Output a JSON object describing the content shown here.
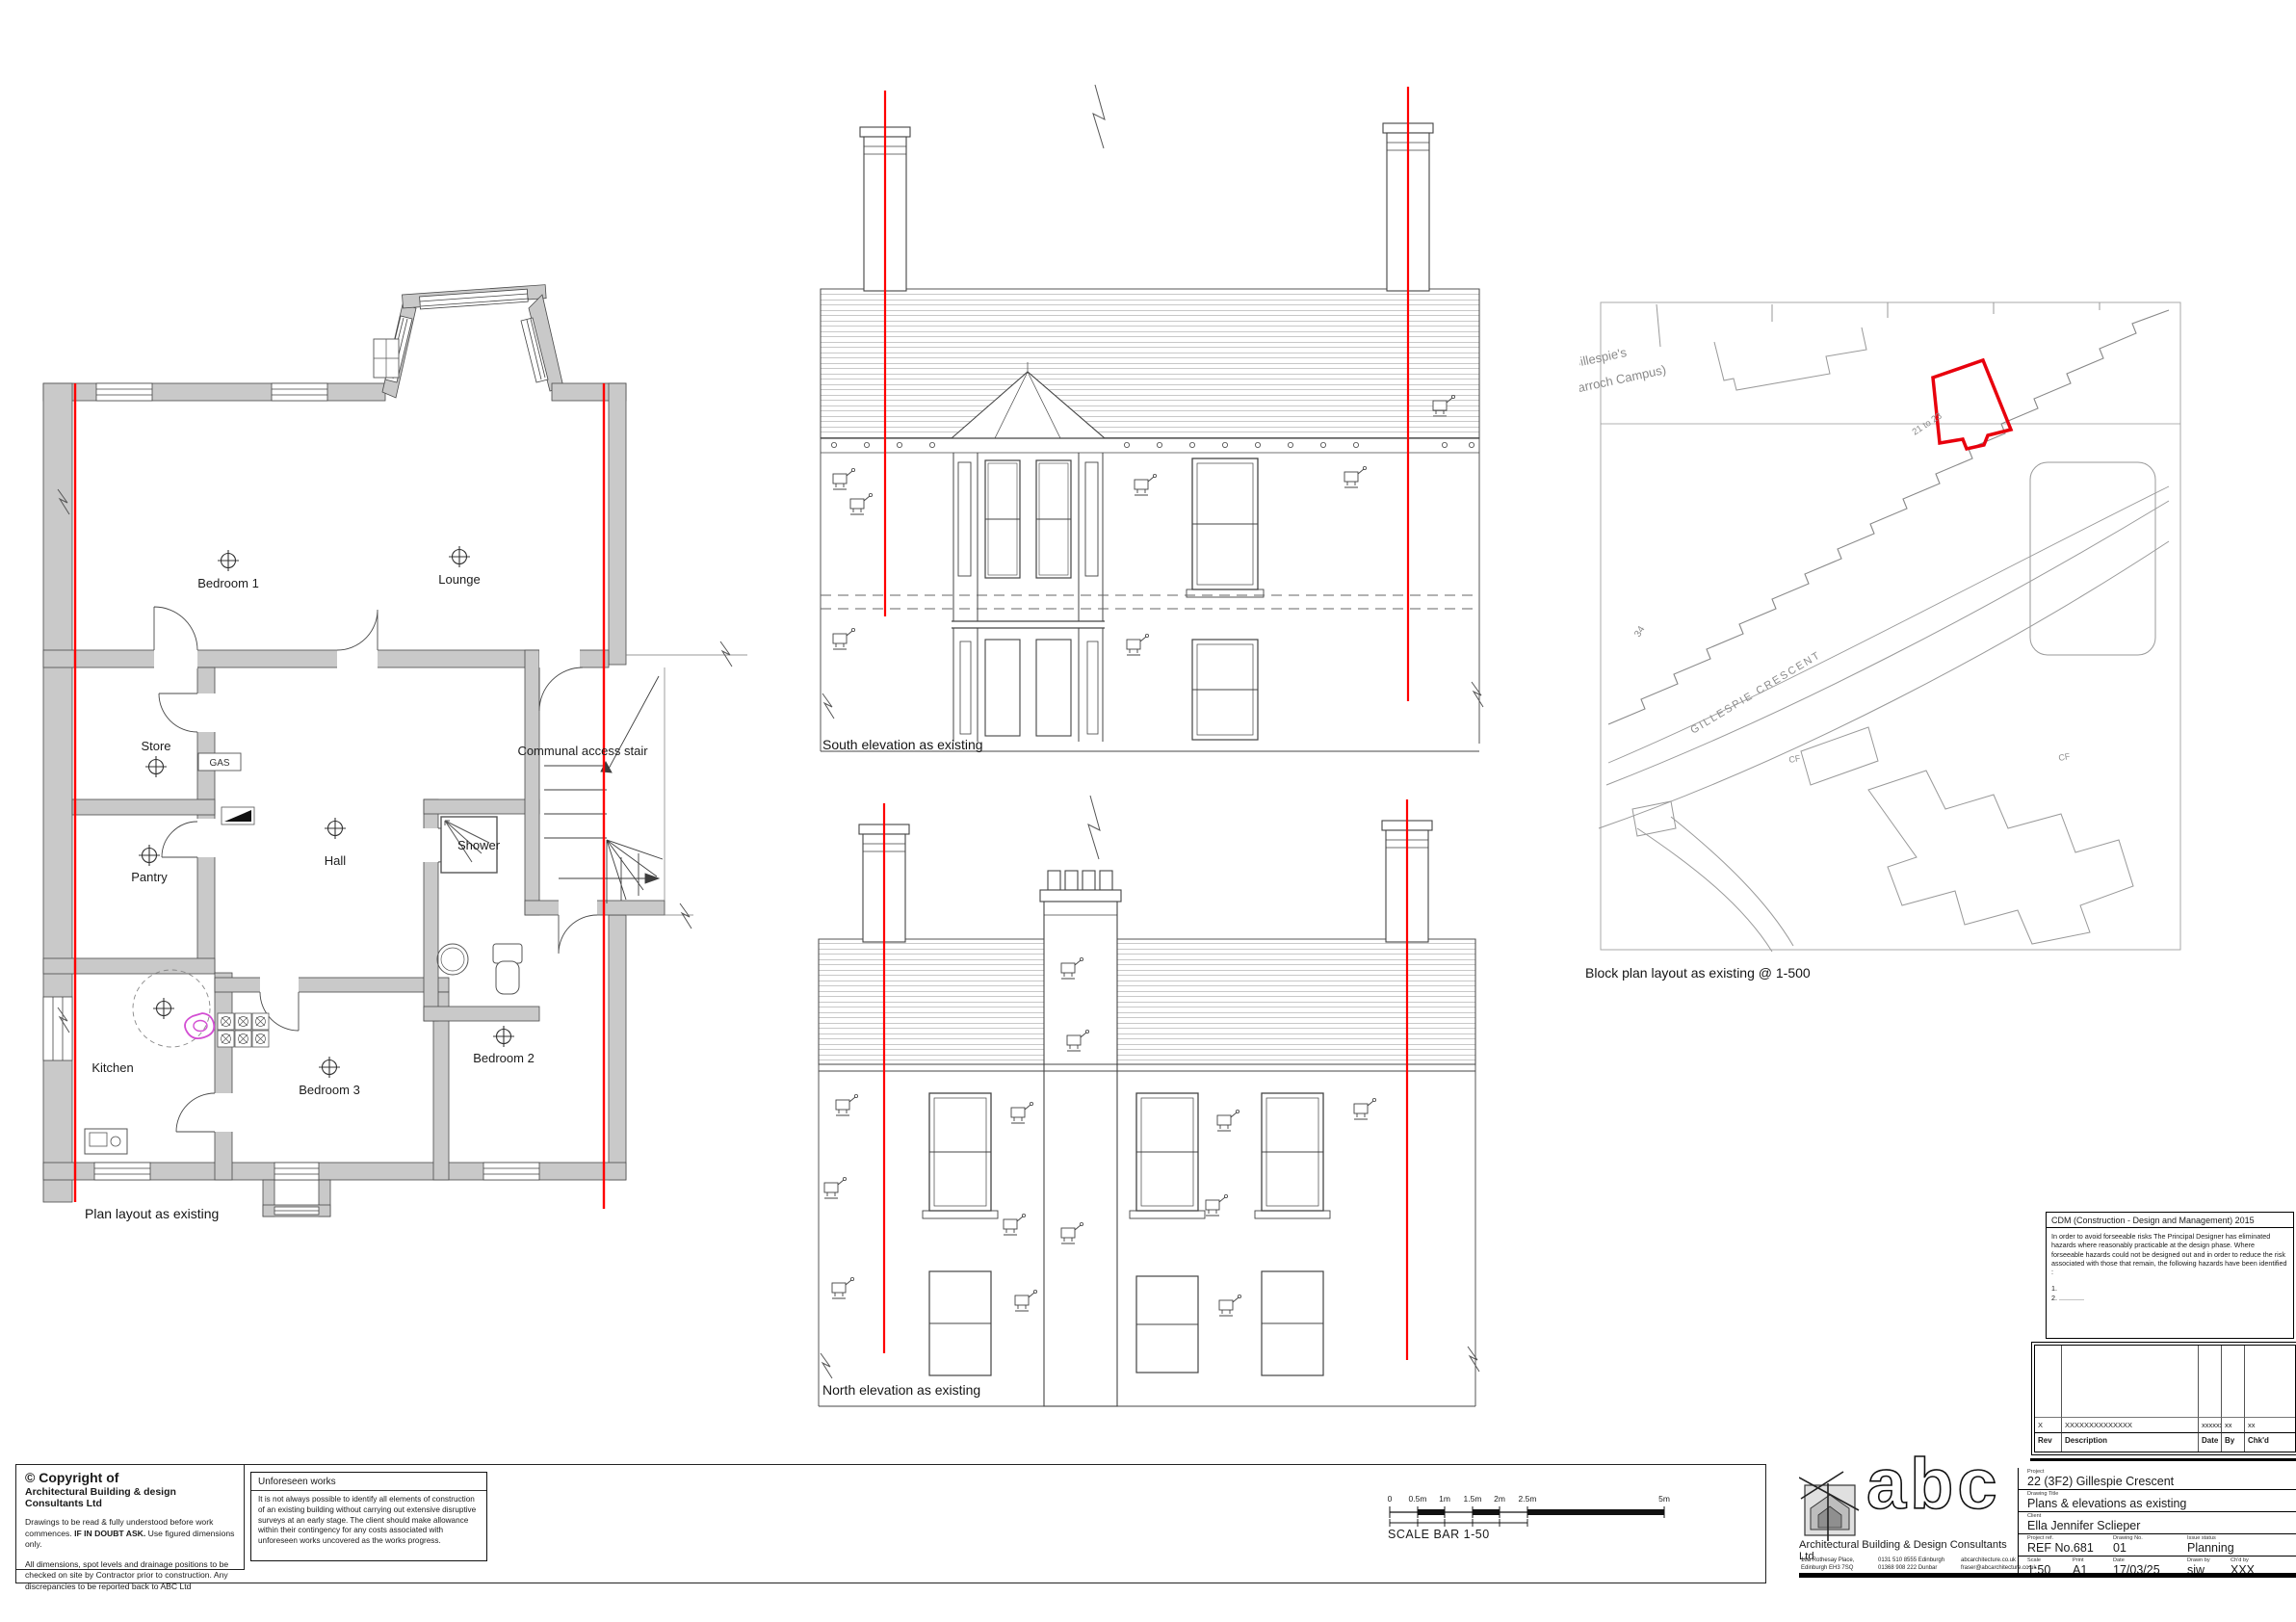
{
  "colors": {
    "section_red": "#ff0000",
    "wall_gray": "#c9c9c9",
    "magenta": "#d34fd3",
    "map_gray": "#999999"
  },
  "captions": {
    "plan": "Plan layout as existing",
    "south": "South elevation as existing",
    "north": "North elevation as existing",
    "block": "Block plan layout as existing @ 1-500"
  },
  "plan": {
    "gas": "GAS",
    "rooms": {
      "bedroom1": "Bedroom 1",
      "lounge": "Lounge",
      "store": "Store",
      "pantry": "Pantry",
      "hall": "Hall",
      "shower": "Shower",
      "kitchen": "Kitchen",
      "bedroom3": "Bedroom 3",
      "bedroom2": "Bedroom 2",
      "stair": "Communal access stair"
    }
  },
  "map": {
    "street": "GILLESPIE CRESCENT",
    "campus_name": "Gillespie's",
    "campus_sub": "(Darroch Campus)",
    "plot_numbers": "21 to 23",
    "house_number": "34",
    "cf": "CF"
  },
  "copyright": {
    "title": "© Copyright of",
    "company": "Architectural Building & design Consultants Ltd",
    "para1_pre": "Drawings to be read & fully understood before work commences.  ",
    "para1_bold": "IF IN DOUBT ASK.",
    "para1_post": " Use figured dimensions only.",
    "para2": "All dimensions, spot levels and drainage positions to be checked on site by Contractor prior to construction. Any discrepancies to be reported back to ABC Ltd"
  },
  "unforeseen": {
    "title": "Unforeseen works",
    "body": "It is not always possible to identify all elements of construction of an existing building without carrying out extensive disruptive surveys at an early stage. The client should make allowance within their contingency for any costs associated with unforeseen works uncovered as the works progress."
  },
  "scalebar": {
    "ticks": [
      "0",
      "0.5m",
      "1m",
      "1.5m",
      "2m",
      "2.5m",
      "5m"
    ],
    "caption": "SCALE BAR 1-50"
  },
  "cdm": {
    "title": "CDM (Construction - Design and Management) 2015",
    "body": "In order to avoid forseeable risks The Principal Designer has eliminated hazards where reasonably practicable at the design phase. Where forseeable hazards could not be designed out and in order to reduce the risk associated with those that remain, the following hazards have been identified :",
    "item1": "1.",
    "item2": "2.  ............."
  },
  "revision": {
    "headers": [
      "Rev",
      "Description",
      "Date",
      "By",
      "Chk'd"
    ],
    "row": [
      "X",
      "XXXXXXXXXXXXXX",
      "xxxxxx",
      "xx",
      "xx"
    ]
  },
  "titleblock": {
    "logo": "abc",
    "company": "Architectural Building & Design Consultants Ltd",
    "address_line1": "18a Rothesay Place,",
    "address_line2": "Edinburgh EH3 7SQ",
    "phone_line1": "0131 510 8555 Edinburgh",
    "phone_line2": "01368 908 222 Dunbar",
    "web": "abcarchitecture.co.uk",
    "email": "fraser@abcarchitecture.co.uk",
    "labels": {
      "project": "Project",
      "drawing_title": "Drawing Title",
      "client": "Client",
      "project_ref": "Project ref.",
      "drawing_no": "Drawing No.",
      "issue_status": "Issue status",
      "scale": "Scale",
      "print": "Print",
      "date": "Date",
      "drawn_by": "Drawn by",
      "chd_by": "Ch'd by"
    },
    "values": {
      "project": "22 (3F2) Gillespie Crescent",
      "drawing_title": "Plans & elevations as existing",
      "client": "Ella Jennifer Sclieper",
      "project_ref": "REF No.681",
      "drawing_no": "01",
      "issue_status": "Planning",
      "scale": "1:50",
      "print": "A1",
      "date": "17/03/25",
      "drawn_by": "sjw",
      "chd_by": "XXX"
    }
  }
}
